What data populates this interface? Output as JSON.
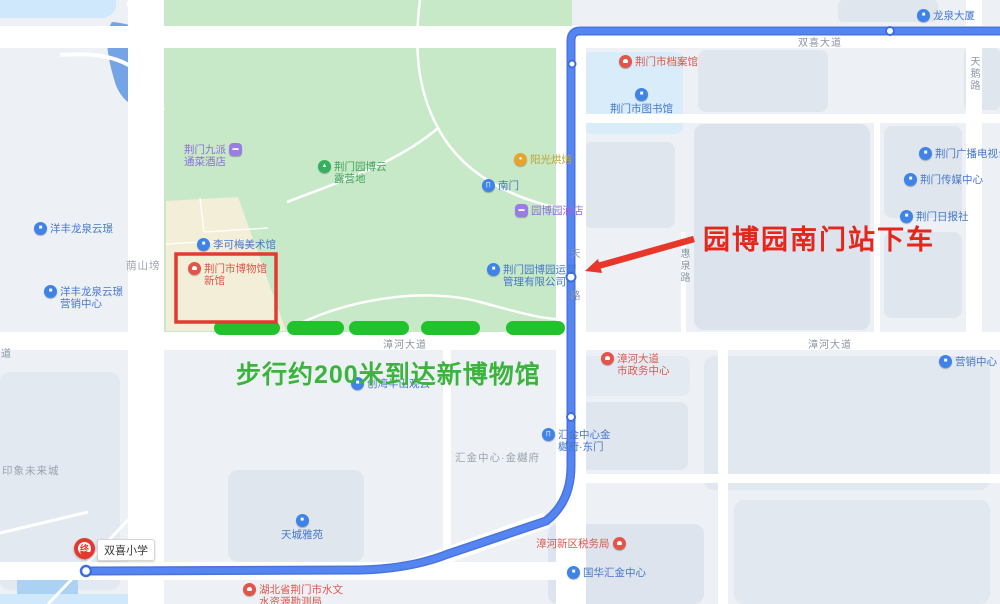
{
  "annotations": {
    "red_note": "园博园南门站下车",
    "green_note": "步行约200米到达新博物馆"
  },
  "school_stop": {
    "bubble": "双喜小学",
    "pin_char": "终"
  },
  "colors": {
    "route_blue": "#4a79ea",
    "walk_green": "#21c32d",
    "note_red": "#e6251b",
    "park_green": "#c7e9c7",
    "highlight_box_red": "#e23b31"
  },
  "roads": [
    {
      "id": "shuangxi-avenue",
      "text": "双喜大道",
      "x": 798,
      "y": 34,
      "vertical": false
    },
    {
      "id": "tiane-road",
      "text": "天鹅路",
      "x": 966,
      "y": 56,
      "vertical": true
    },
    {
      "id": "huiquan-road",
      "text": "惠泉路",
      "x": 676,
      "y": 248,
      "vertical": true
    },
    {
      "id": "zhanghe-avenue-west",
      "text": "漳河大道",
      "x": 383,
      "y": 336,
      "vertical": false
    },
    {
      "id": "zhanghe-avenue-east",
      "text": "漳河大道",
      "x": 808,
      "y": 336,
      "vertical": false
    },
    {
      "id": "partial-avenue",
      "text": "大道",
      "x": -10,
      "y": 345,
      "vertical": false
    },
    {
      "id": "station-road-char-top",
      "text": "天",
      "x": 566,
      "y": 248,
      "vertical": true
    },
    {
      "id": "station-road-char-bottom",
      "text": "路",
      "x": 566,
      "y": 290,
      "vertical": true
    }
  ],
  "areas": [
    {
      "id": "yinshanbang",
      "text": "荫山塝",
      "x": 126,
      "y": 258
    },
    {
      "id": "yinxiang-future-city",
      "text": "印象未来城",
      "x": 2,
      "y": 463
    },
    {
      "id": "huijin-jinyuefu",
      "text": "汇金中心·金樾府",
      "x": 455,
      "y": 450
    }
  ],
  "pois": [
    {
      "id": "jiupai-hotel",
      "icon": "hotel-icon",
      "type": "purple",
      "text_first": true,
      "lines": [
        "荆门九派",
        "通菜酒店"
      ],
      "x": 184,
      "y": 143
    },
    {
      "id": "yuanbo-cloud-camp",
      "icon": "tent-icon",
      "type": "green",
      "lines": [
        "荆门园博云",
        "露营地"
      ],
      "x": 318,
      "y": 160
    },
    {
      "id": "bakery",
      "icon": "shop-icon",
      "type": "orange",
      "lines": [
        "阳光烘焙"
      ],
      "x": 514,
      "y": 153
    },
    {
      "id": "south-gate",
      "icon": "gate-icon",
      "type": "blue",
      "lines": [
        "南门"
      ],
      "x": 482,
      "y": 179
    },
    {
      "id": "yuanboyuan-hotel",
      "icon": "hotel-icon",
      "type": "purple",
      "lines": [
        "园博园酒店"
      ],
      "x": 515,
      "y": 204
    },
    {
      "id": "likemei-art-museum",
      "icon": "museum-icon",
      "type": "blue",
      "lines": [
        "李可梅美术馆"
      ],
      "x": 197,
      "y": 238
    },
    {
      "id": "jingmen-museum-new",
      "icon": "pin-icon",
      "type": "red",
      "lines": [
        "荆门市博物馆",
        "新馆"
      ],
      "x": 188,
      "y": 262
    },
    {
      "id": "yuanbo-operations",
      "icon": "building-icon",
      "type": "blue",
      "lines": [
        "荆门园博园运营",
        "管理有限公司"
      ],
      "x": 487,
      "y": 263
    },
    {
      "id": "yangfeng-longquan",
      "icon": "building-icon",
      "type": "blue",
      "lines": [
        "洋丰龙泉云璟"
      ],
      "x": 34,
      "y": 222
    },
    {
      "id": "yangfeng-sales-center",
      "icon": "building-icon",
      "type": "blue",
      "lines": [
        "洋丰龙泉云璟",
        "营销中心"
      ],
      "x": 44,
      "y": 285
    },
    {
      "id": "archives",
      "icon": "pin-icon",
      "type": "red",
      "lines": [
        "荆门市档案馆"
      ],
      "x": 619,
      "y": 55
    },
    {
      "id": "library",
      "icon": "library-icon",
      "type": "blue",
      "stack": true,
      "lines": [
        "荆门市图书馆"
      ],
      "x": 610,
      "y": 88
    },
    {
      "id": "longquan-tower",
      "icon": "building-icon",
      "type": "blue",
      "lines": [
        "龙泉大厦"
      ],
      "x": 917,
      "y": 9
    },
    {
      "id": "broadcast-tv",
      "icon": "tv-icon",
      "type": "blue",
      "lines": [
        "荆门广播电视台"
      ],
      "x": 919,
      "y": 147
    },
    {
      "id": "media-center",
      "icon": "building-icon",
      "type": "blue",
      "lines": [
        "荆门传媒中心"
      ],
      "x": 904,
      "y": 173
    },
    {
      "id": "daily-news",
      "icon": "building-icon",
      "type": "blue",
      "lines": [
        "荆门日报社"
      ],
      "x": 900,
      "y": 210
    },
    {
      "id": "gov-center",
      "icon": "pin-icon",
      "type": "red",
      "lines": [
        "漳河大道",
        "市政务中心"
      ],
      "x": 601,
      "y": 352
    },
    {
      "id": "marketing-center",
      "icon": "building-icon",
      "type": "blue",
      "lines": [
        "营销中心"
      ],
      "x": 939,
      "y": 355
    },
    {
      "id": "huijin-east-gate",
      "icon": "gate-icon",
      "type": "blue",
      "lines": [
        "汇金中心金",
        "樾府·东门"
      ],
      "x": 542,
      "y": 428
    },
    {
      "id": "tax-bureau",
      "icon": "pin-icon",
      "type": "red",
      "text_first": true,
      "lines": [
        "漳河新区税务局"
      ],
      "x": 536,
      "y": 537
    },
    {
      "id": "guohua-huijin",
      "icon": "building-icon",
      "type": "blue",
      "lines": [
        "国华汇金中心"
      ],
      "x": 567,
      "y": 566
    },
    {
      "id": "tiancheng-yayuan",
      "icon": "building-icon",
      "type": "blue",
      "stack": true,
      "lines": [
        "天城雅苑"
      ],
      "x": 281,
      "y": 514
    },
    {
      "id": "hydrology-bureau",
      "icon": "pin-icon",
      "type": "red",
      "lines": [
        "湖北省荆门市水文",
        "水资源勘测局"
      ],
      "x": 243,
      "y": 583
    },
    {
      "id": "banshan-guanyun",
      "icon": "building-icon",
      "type": "blue",
      "lines": [
        "创湾半山观云"
      ],
      "x": 351,
      "y": 377
    }
  ]
}
